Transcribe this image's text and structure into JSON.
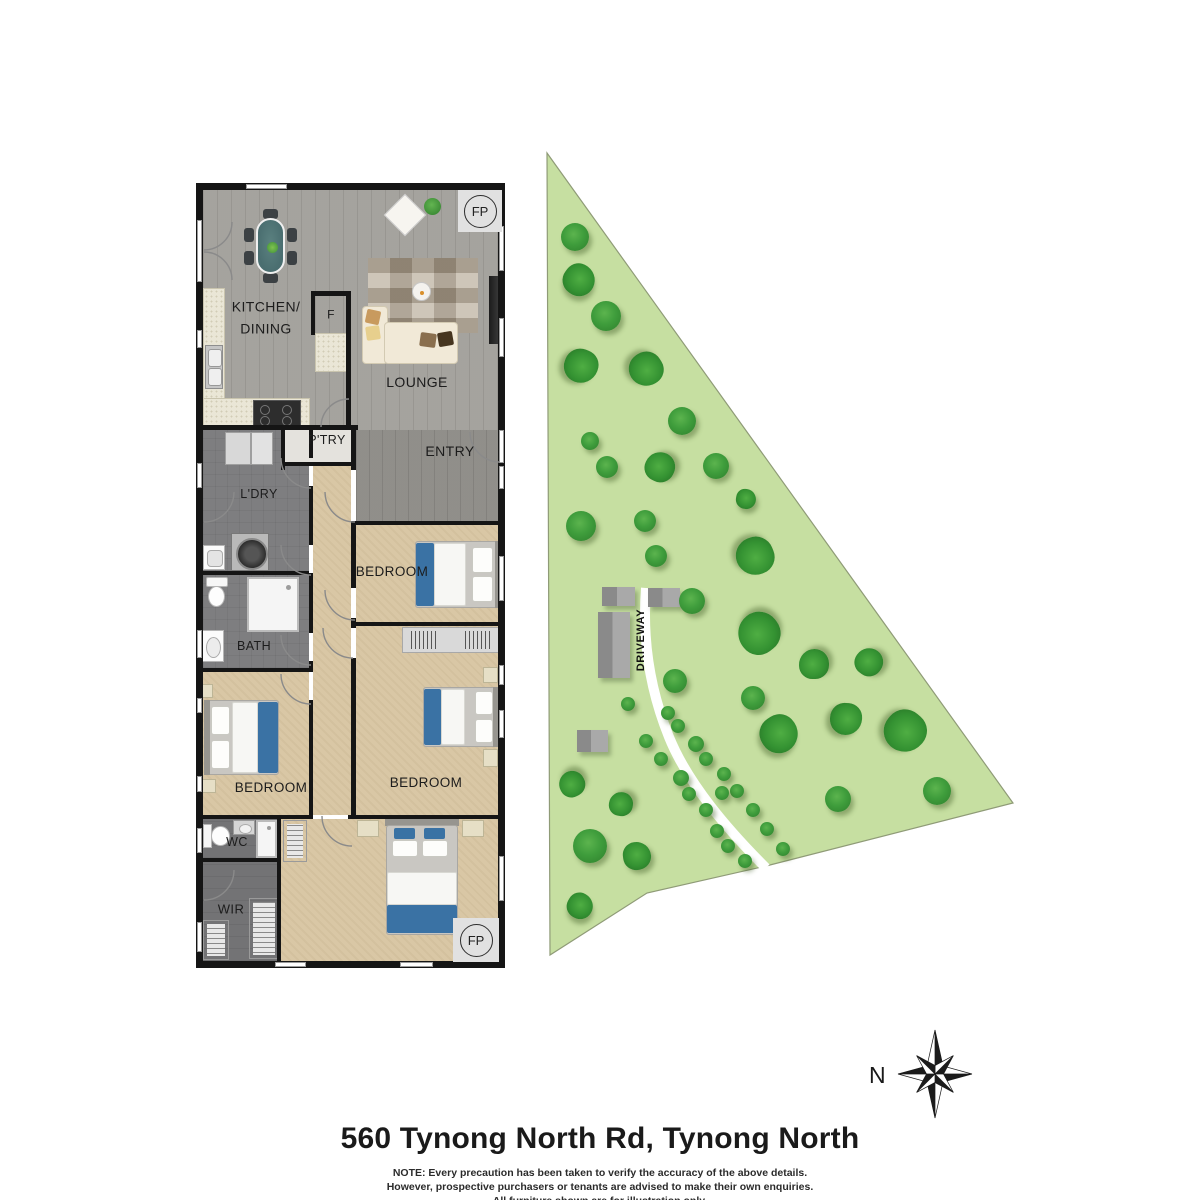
{
  "floorplan": {
    "room_labels": [
      {
        "id": "kitchen-dining",
        "text": "KITCHEN/\nDINING",
        "x": 266,
        "y": 318,
        "size": 14
      },
      {
        "id": "fridge",
        "text": "F",
        "x": 331,
        "y": 315,
        "size": 12
      },
      {
        "id": "lounge",
        "text": "LOUNGE",
        "x": 417,
        "y": 382,
        "size": 14
      },
      {
        "id": "entry",
        "text": "ENTRY",
        "x": 450,
        "y": 451,
        "size": 14
      },
      {
        "id": "pantry",
        "text": "P'TRY",
        "x": 327,
        "y": 440,
        "size": 12.5
      },
      {
        "id": "laundry",
        "text": "L'DRY",
        "x": 259,
        "y": 494,
        "size": 12.5
      },
      {
        "id": "bath",
        "text": "BATH",
        "x": 254,
        "y": 646,
        "size": 12.5
      },
      {
        "id": "bedroom-1",
        "text": "BEDROOM",
        "x": 392,
        "y": 572,
        "size": 13.5
      },
      {
        "id": "bedroom-2",
        "text": "BEDROOM",
        "x": 426,
        "y": 783,
        "size": 13.5
      },
      {
        "id": "bedroom-3",
        "text": "BEDROOM",
        "x": 271,
        "y": 788,
        "size": 13.5
      },
      {
        "id": "wc",
        "text": "WC",
        "x": 237,
        "y": 842,
        "size": 12.5
      },
      {
        "id": "wir",
        "text": "WIR",
        "x": 231,
        "y": 910,
        "size": 13
      }
    ],
    "badges": [
      {
        "text": "FP",
        "x": 458,
        "y": 190,
        "w": 44,
        "h": 42
      },
      {
        "text": "FP",
        "x": 453,
        "y": 918,
        "w": 46,
        "h": 44
      }
    ]
  },
  "site": {
    "driveway_label": "DRIVEWAY",
    "colors": {
      "land": "#c6dfa1",
      "land_edge": "#8f9b77",
      "tree_smooth": "#3f9d3c",
      "tree_fluffy": "#349232",
      "driveway": "#ffffff"
    },
    "buildings": [
      {
        "x": 602,
        "y": 587,
        "w": 33,
        "h": 19
      },
      {
        "x": 648,
        "y": 588,
        "w": 32,
        "h": 19
      },
      {
        "x": 598,
        "y": 612,
        "w": 32,
        "h": 66
      },
      {
        "x": 577,
        "y": 730,
        "w": 31,
        "h": 22
      }
    ],
    "trees": [
      {
        "x": 575,
        "y": 237,
        "r": 14,
        "t": 1
      },
      {
        "x": 579,
        "y": 280,
        "r": 16,
        "t": 2
      },
      {
        "x": 606,
        "y": 316,
        "r": 15,
        "t": 1
      },
      {
        "x": 581,
        "y": 366,
        "r": 17,
        "t": 2
      },
      {
        "x": 646,
        "y": 369,
        "r": 17,
        "t": 2
      },
      {
        "x": 682,
        "y": 421,
        "r": 14,
        "t": 1
      },
      {
        "x": 590,
        "y": 441,
        "r": 9,
        "t": 1
      },
      {
        "x": 607,
        "y": 467,
        "r": 11,
        "t": 1
      },
      {
        "x": 660,
        "y": 467,
        "r": 15,
        "t": 2
      },
      {
        "x": 716,
        "y": 466,
        "r": 13,
        "t": 1
      },
      {
        "x": 746,
        "y": 499,
        "r": 10,
        "t": 2
      },
      {
        "x": 581,
        "y": 526,
        "r": 15,
        "t": 1
      },
      {
        "x": 645,
        "y": 521,
        "r": 11,
        "t": 1
      },
      {
        "x": 656,
        "y": 556,
        "r": 11,
        "t": 1
      },
      {
        "x": 755,
        "y": 556,
        "r": 19,
        "t": 2
      },
      {
        "x": 692,
        "y": 601,
        "r": 13,
        "t": 1
      },
      {
        "x": 759,
        "y": 633,
        "r": 21,
        "t": 2
      },
      {
        "x": 814,
        "y": 664,
        "r": 15,
        "t": 2
      },
      {
        "x": 869,
        "y": 662,
        "r": 14,
        "t": 2
      },
      {
        "x": 675,
        "y": 681,
        "r": 12,
        "t": 1
      },
      {
        "x": 753,
        "y": 698,
        "r": 12,
        "t": 1
      },
      {
        "x": 779,
        "y": 734,
        "r": 19,
        "t": 2
      },
      {
        "x": 846,
        "y": 719,
        "r": 16,
        "t": 2
      },
      {
        "x": 905,
        "y": 731,
        "r": 21,
        "t": 2
      },
      {
        "x": 937,
        "y": 791,
        "r": 14,
        "t": 1
      },
      {
        "x": 838,
        "y": 799,
        "r": 13,
        "t": 1
      },
      {
        "x": 572,
        "y": 784,
        "r": 13,
        "t": 2
      },
      {
        "x": 621,
        "y": 804,
        "r": 12,
        "t": 2
      },
      {
        "x": 590,
        "y": 846,
        "r": 17,
        "t": 1
      },
      {
        "x": 637,
        "y": 856,
        "r": 14,
        "t": 2
      },
      {
        "x": 580,
        "y": 906,
        "r": 13,
        "t": 2
      },
      {
        "x": 628,
        "y": 704,
        "r": 7,
        "t": 1
      },
      {
        "x": 668,
        "y": 713,
        "r": 7,
        "t": 1
      },
      {
        "x": 678,
        "y": 726,
        "r": 7,
        "t": 1
      },
      {
        "x": 646,
        "y": 741,
        "r": 7,
        "t": 1
      },
      {
        "x": 696,
        "y": 744,
        "r": 8,
        "t": 1
      },
      {
        "x": 706,
        "y": 759,
        "r": 7,
        "t": 1
      },
      {
        "x": 661,
        "y": 759,
        "r": 7,
        "t": 1
      },
      {
        "x": 724,
        "y": 774,
        "r": 7,
        "t": 1
      },
      {
        "x": 681,
        "y": 778,
        "r": 8,
        "t": 1
      },
      {
        "x": 737,
        "y": 791,
        "r": 7,
        "t": 1
      },
      {
        "x": 689,
        "y": 794,
        "r": 7,
        "t": 1
      },
      {
        "x": 722,
        "y": 793,
        "r": 7,
        "t": 1
      },
      {
        "x": 753,
        "y": 810,
        "r": 7,
        "t": 1
      },
      {
        "x": 706,
        "y": 810,
        "r": 7,
        "t": 1
      },
      {
        "x": 767,
        "y": 829,
        "r": 7,
        "t": 1
      },
      {
        "x": 717,
        "y": 831,
        "r": 7,
        "t": 1
      },
      {
        "x": 783,
        "y": 849,
        "r": 7,
        "t": 1
      },
      {
        "x": 728,
        "y": 846,
        "r": 7,
        "t": 1
      },
      {
        "x": 745,
        "y": 861,
        "r": 7,
        "t": 1
      }
    ]
  },
  "compass": {
    "north_label": "N"
  },
  "footer": {
    "address": "560 Tynong North Rd, Tynong North",
    "note_lines": [
      "NOTE: Every precaution has been taken to verify the accuracy of the above details.",
      "However, prospective purchasers or tenants are advised to make their own enquiries.",
      "All furniture shown are for illustration only."
    ]
  }
}
